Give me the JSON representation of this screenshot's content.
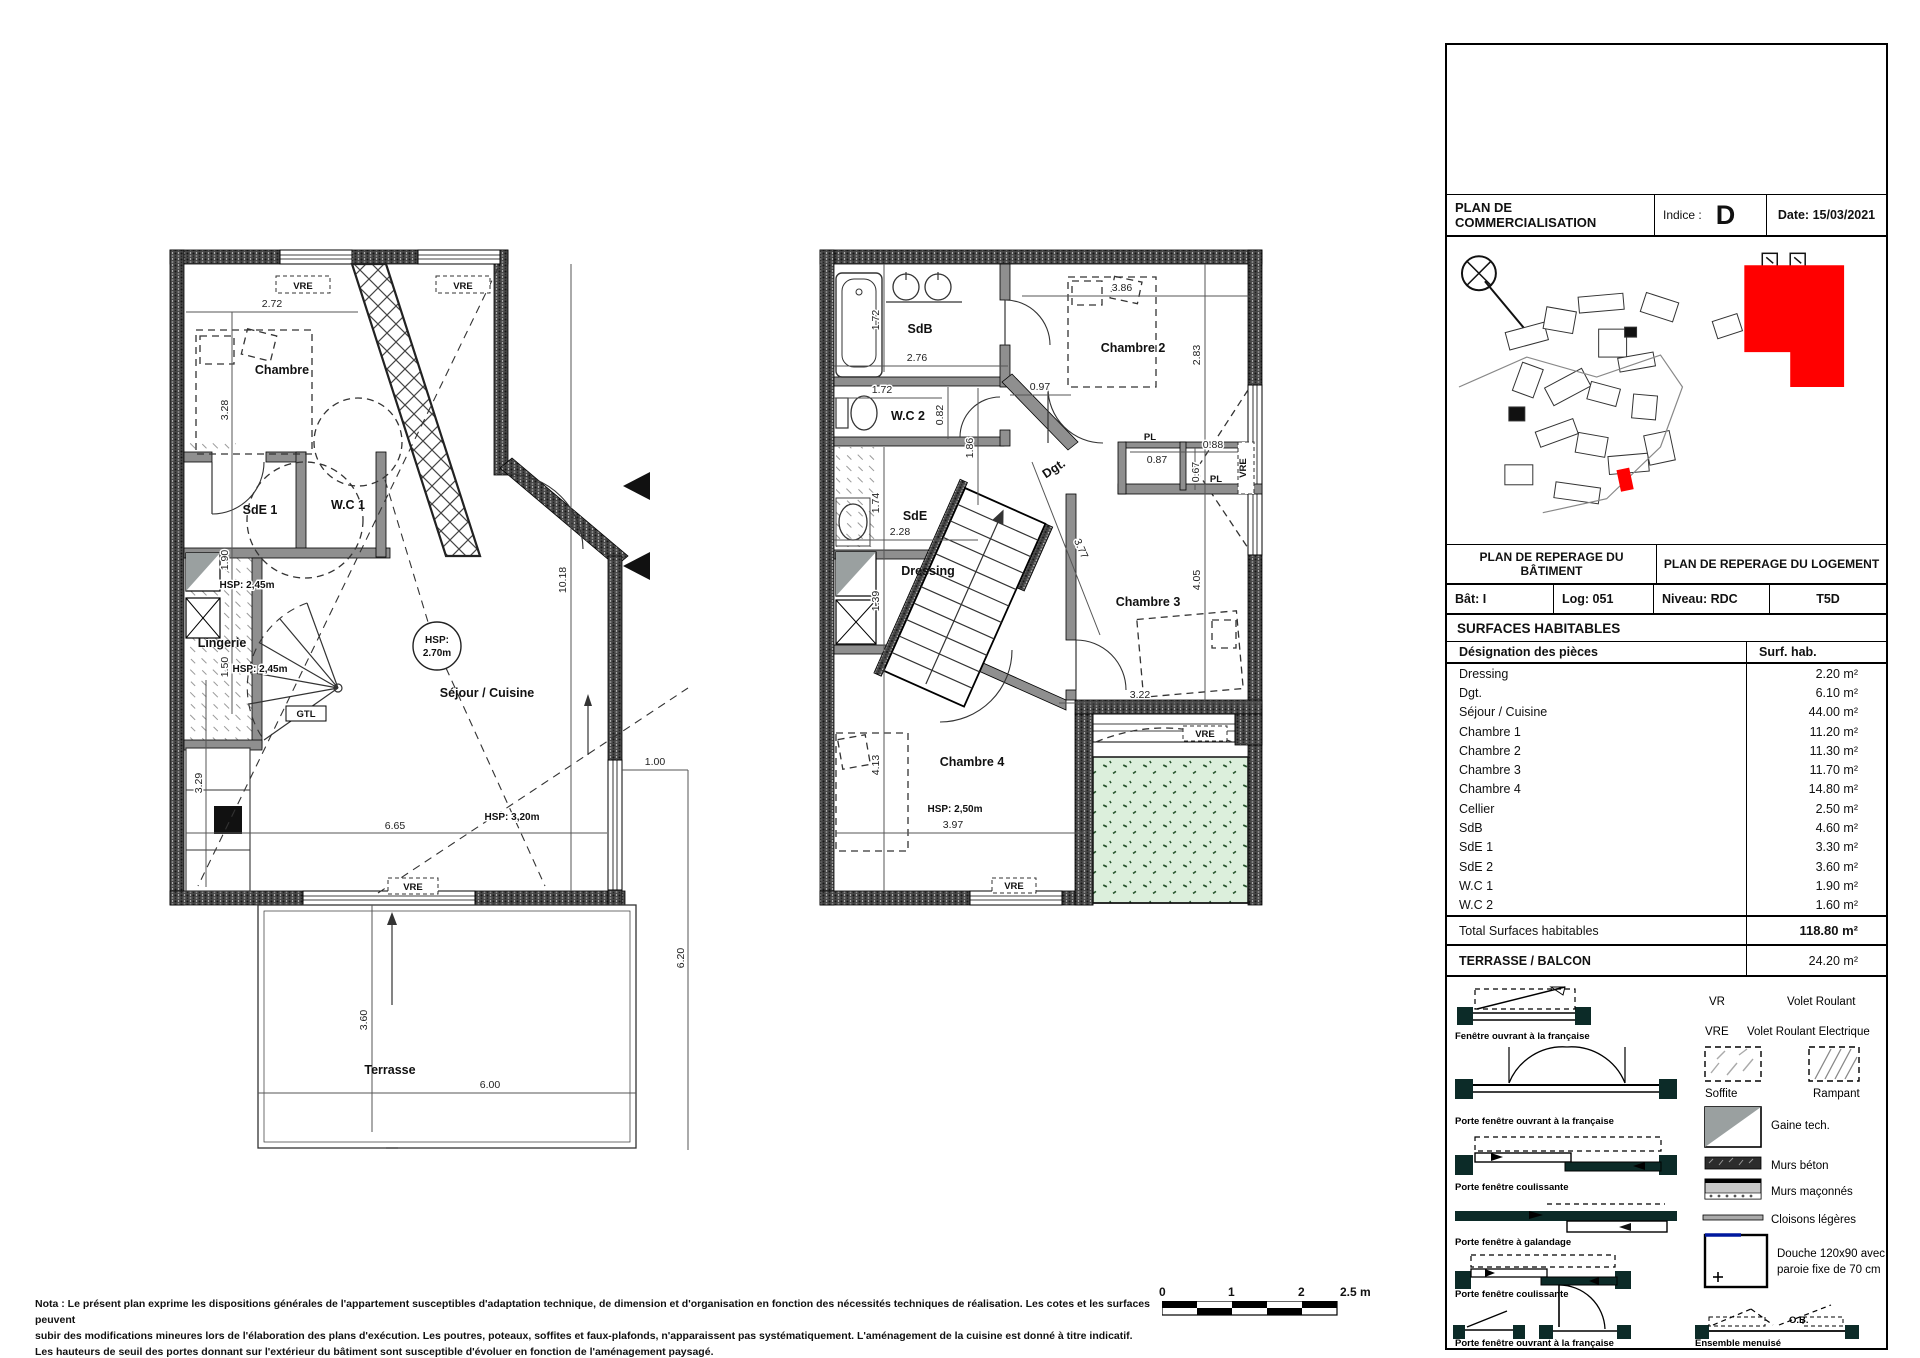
{
  "titleblock": {
    "title": "PLAN DE COMMERCIALISATION",
    "indice_label": "Indice :",
    "indice_value": "D",
    "date": "Date: 15/03/2021",
    "reperage_batiment": "PLAN DE REPERAGE DU BÂTIMENT",
    "reperage_logement": "PLAN DE REPERAGE DU LOGEMENT",
    "bat": "Bât: I",
    "log": "Log: 051",
    "niveau": "Niveau: RDC",
    "type": "T5D",
    "surfaces_title": "SURFACES HABITABLES",
    "col_designation": "Désignation des pièces",
    "col_surface": "Surf. hab.",
    "rows": [
      {
        "name": "Dressing",
        "value": "2.20 m²"
      },
      {
        "name": "Dgt.",
        "value": "6.10 m²"
      },
      {
        "name": "Séjour / Cuisine",
        "value": "44.00 m²"
      },
      {
        "name": "Chambre 1",
        "value": "11.20 m²"
      },
      {
        "name": "Chambre 2",
        "value": "11.30 m²"
      },
      {
        "name": "Chambre 3",
        "value": "11.70 m²"
      },
      {
        "name": "Chambre 4",
        "value": "14.80 m²"
      },
      {
        "name": "Cellier",
        "value": "2.50 m²"
      },
      {
        "name": "SdB",
        "value": "4.60 m²"
      },
      {
        "name": "SdE 1",
        "value": "3.30 m²"
      },
      {
        "name": "SdE 2",
        "value": "3.60 m²"
      },
      {
        "name": "W.C 1",
        "value": "1.90 m²"
      },
      {
        "name": "W.C 2",
        "value": "1.60 m²"
      }
    ],
    "total_label": "Total Surfaces habitables",
    "total_value": "118.80 m²",
    "terrasse_label": "TERRASSE / BALCON",
    "terrasse_value": "24.20 m²"
  },
  "legend": {
    "items_left": [
      "Fenêtre ouvrant à la française",
      "Porte fenêtre ouvrant à la française",
      "Porte fenêtre coulissante",
      "Porte fenêtre à galandage",
      "Porte fenêtre coulissante",
      "Porte fenêtre ouvrant à la française"
    ],
    "ensemble": "Ensemble menuisé",
    "ob": "O.B.",
    "vr_abbr": "VR",
    "vr_label": "Volet Roulant",
    "vre_abbr": "VRE",
    "vre_label": "Volet Roulant Electrique",
    "soffite": "Soffite",
    "rampant": "Rampant",
    "gaine": "Gaine tech.",
    "murs_beton": "Murs béton",
    "murs_maconnes": "Murs maçonnés",
    "cloisons": "Cloisons légères",
    "douche_l1": "Douche 120x90 avec",
    "douche_l2": "paroie fixe de 70 cm"
  },
  "plan_rdc": {
    "labels": {
      "chambre": "Chambre",
      "sde1": "SdE 1",
      "wc1": "W.C 1",
      "lingerie": "Lingerie",
      "sejour": "Séjour / Cuisine",
      "terrasse": "Terrasse",
      "gtl": "GTL",
      "hsp_circle_1": "HSP:",
      "hsp_circle_2": "2.70m",
      "hsp245": "HSP: 2,45m",
      "hsp320": "HSP: 3,20m",
      "vre": "VRE"
    },
    "dims": {
      "w272": "2.72",
      "h328": "3.28",
      "h190": "1.90",
      "h150": "1.50",
      "h329": "3.29",
      "w665": "6.65",
      "h1018": "10.18",
      "w100": "1.00",
      "h620": "6.20",
      "w600": "6.00",
      "h360": "3.60"
    }
  },
  "plan_etage": {
    "labels": {
      "sdb": "SdB",
      "wc2": "W.C 2",
      "chambre2": "Chambre 2",
      "dgt": "Dgt.",
      "sde": "SdE",
      "dressing": "Dressing",
      "chambre3": "Chambre 3",
      "chambre4": "Chambre 4",
      "pl": "PL",
      "hsp250": "HSP: 2,50m",
      "vre": "VRE"
    },
    "dims": {
      "v172": "1.72",
      "w276": "2.76",
      "w172": "1.72",
      "w097": "0.97",
      "v082": "0.82",
      "v186": "1.86",
      "w386": "3.86",
      "v283": "2.83",
      "w087": "0.87",
      "w088": "0.88",
      "v067": "0.67",
      "v174": "1.74",
      "w228": "2.28",
      "v139": "1.39",
      "d377": "3.77",
      "v405": "4.05",
      "w322": "3.22",
      "v413": "4.13",
      "w397": "3.97"
    }
  },
  "note": {
    "line1": "Nota : Le présent plan exprime les dispositions générales de l'appartement susceptibles d'adaptation technique, de dimension et d'organisation en fonction des nécessités techniques de réalisation. Les cotes et les surfaces peuvent",
    "line2": "subir des modifications mineures lors de l'élaboration des plans d'exécution. Les poutres, poteaux, soffites et faux-plafonds, n'apparaissent pas systématiquement. L'aménagement de la cuisine est donné à titre indicatif.",
    "line3": "Les hauteurs de seuil des portes donnant sur l'extérieur du bâtiment sont susceptible d'évoluer en fonction de l'aménagement paysagé."
  },
  "scale": {
    "t0": "0",
    "t1": "1",
    "t2": "2",
    "t25": "2.5 m"
  },
  "colors": {
    "terrace_green": "#dcefdc",
    "highlight_red": "#ff0000",
    "wall_gray": "#474747"
  }
}
